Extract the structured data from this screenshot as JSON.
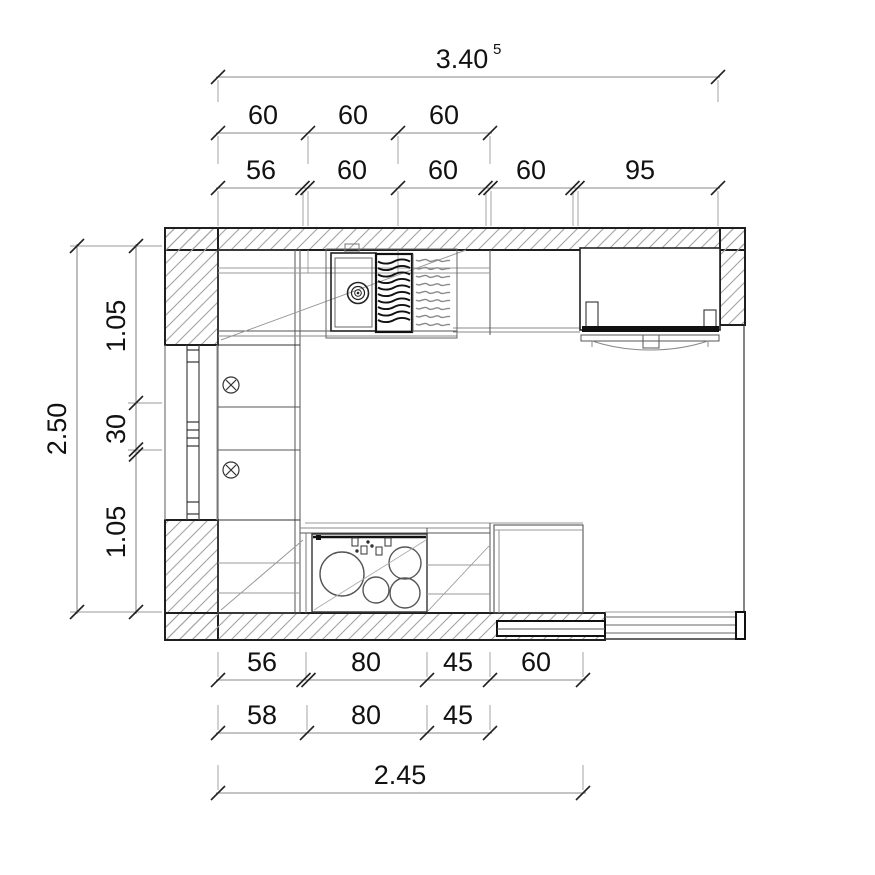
{
  "colors": {
    "background": "#ffffff",
    "wall_outline": "#1f1f1f",
    "hatch": "#a3a3a3",
    "cabinet_line": "#555555",
    "dim_line": "#888888",
    "text": "#111111"
  },
  "dimensions": {
    "top": {
      "overall": "3.40",
      "overall_superscript": "5",
      "row_upper": [
        "60",
        "60",
        "60"
      ],
      "row_lower": [
        "56",
        "60",
        "60",
        "60",
        "95"
      ]
    },
    "left": {
      "overall": "2.50",
      "segments": [
        "1.05",
        "30",
        "1.05"
      ]
    },
    "bottom": {
      "row_upper": [
        "56",
        "80",
        "45",
        "60"
      ],
      "row_lower": [
        "58",
        "80",
        "45"
      ],
      "overall": "2.45"
    }
  },
  "elements": {
    "window": "window-with-mullions",
    "sink": "kitchen-sink-with-drain",
    "drainer_bold": "dish-drainer-rack",
    "drainer_light": "dish-drainer-rack-2",
    "cooktop": "four-burner-cooktop",
    "appliance": "range-cooker",
    "door": "sliding-door",
    "sockets": [
      "socket-symbol",
      "socket-symbol"
    ]
  }
}
